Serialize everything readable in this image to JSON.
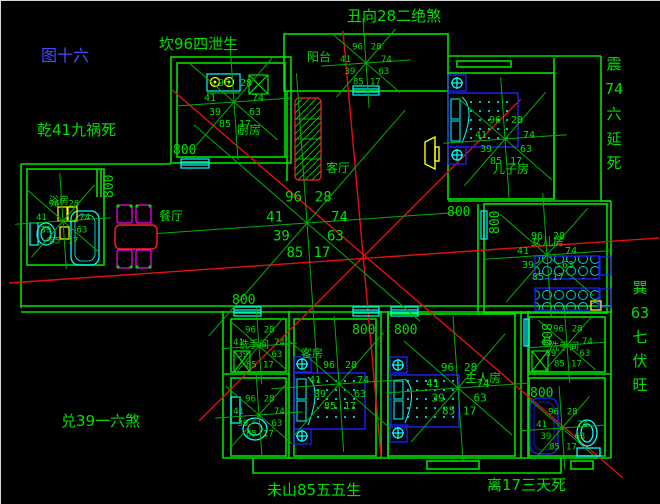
{
  "figure": {
    "title": "图十六"
  },
  "annotations": {
    "top_left": "坎96四泄生",
    "top_center": "丑向28二绝煞",
    "left_upper": "乾41九祸死",
    "bottom_left": "兑39一六煞",
    "bottom_center": "未山85五五生",
    "bottom_right": "离17三天死",
    "right_top_vertical": [
      "震",
      "74",
      "六",
      "延",
      "死"
    ],
    "right_bottom_vertical": [
      "巽",
      "63",
      "七",
      "伏",
      "旺"
    ]
  },
  "rooms": {
    "kitchen": "厨房",
    "balcony": "阳台",
    "living": "客厅",
    "dining": "餐厅",
    "son": "儿子房",
    "daughter": "女儿房",
    "guest": "客房",
    "master": "主人房",
    "bath_left": "浴房",
    "wash_bottom_left": "洗手间",
    "wash_top_right": "洗手间",
    "bath_bottom_right": "卫生间"
  },
  "compass": {
    "numbers": {
      "n96": "96",
      "n28": "28",
      "n41": "41",
      "n74": "74",
      "n39": "39",
      "n63": "63",
      "n85": "85",
      "n17": "17"
    },
    "instances": [
      {
        "cx": 233,
        "cy": 101,
        "k": 1,
        "r": 58
      },
      {
        "cx": 365,
        "cy": 62,
        "k": 0.85,
        "r": 45
      },
      {
        "cx": 504,
        "cy": 138,
        "k": 1,
        "r": 62
      },
      {
        "cx": 306,
        "cy": 222,
        "k": 1.35,
        "r": 150
      },
      {
        "cx": 62,
        "cy": 220,
        "k": 0.9,
        "r": 48
      },
      {
        "cx": 546,
        "cy": 254,
        "k": 1,
        "r": 62
      },
      {
        "cx": 258,
        "cy": 345,
        "k": 0.85,
        "r": 38
      },
      {
        "cx": 258,
        "cy": 414,
        "k": 0.85,
        "r": 44
      },
      {
        "cx": 338,
        "cy": 383,
        "k": 1,
        "r": 68
      },
      {
        "cx": 457,
        "cy": 387,
        "k": 1.05,
        "r": 72
      },
      {
        "cx": 566,
        "cy": 344,
        "k": 0.85,
        "r": 38
      },
      {
        "cx": 561,
        "cy": 427,
        "k": 0.85,
        "r": 42
      }
    ],
    "ray_angles": [
      -4,
      41,
      86,
      131,
      176,
      221,
      266,
      311
    ]
  },
  "dimensions": {
    "label": "800",
    "positions": [
      {
        "x": 172,
        "y": 153,
        "rot": 0
      },
      {
        "x": 112,
        "y": 197,
        "rot": -90
      },
      {
        "x": 446,
        "y": 215,
        "rot": 0
      },
      {
        "x": 498,
        "y": 233,
        "rot": -90
      },
      {
        "x": 231,
        "y": 303,
        "rot": 0
      },
      {
        "x": 351,
        "y": 333,
        "rot": 0
      },
      {
        "x": 393,
        "y": 333,
        "rot": 0
      },
      {
        "x": 529,
        "y": 396,
        "rot": 0
      },
      {
        "x": 541,
        "y": 322,
        "rot": 90
      }
    ]
  },
  "colors": {
    "wall_green": "#00e000",
    "cyan": "#00ffff",
    "red": "#e01010",
    "blue": "#2020ff",
    "yellow": "#ffff00",
    "magenta": "#ff00ff",
    "title_blue": "#4848ff",
    "background": "#000000"
  }
}
